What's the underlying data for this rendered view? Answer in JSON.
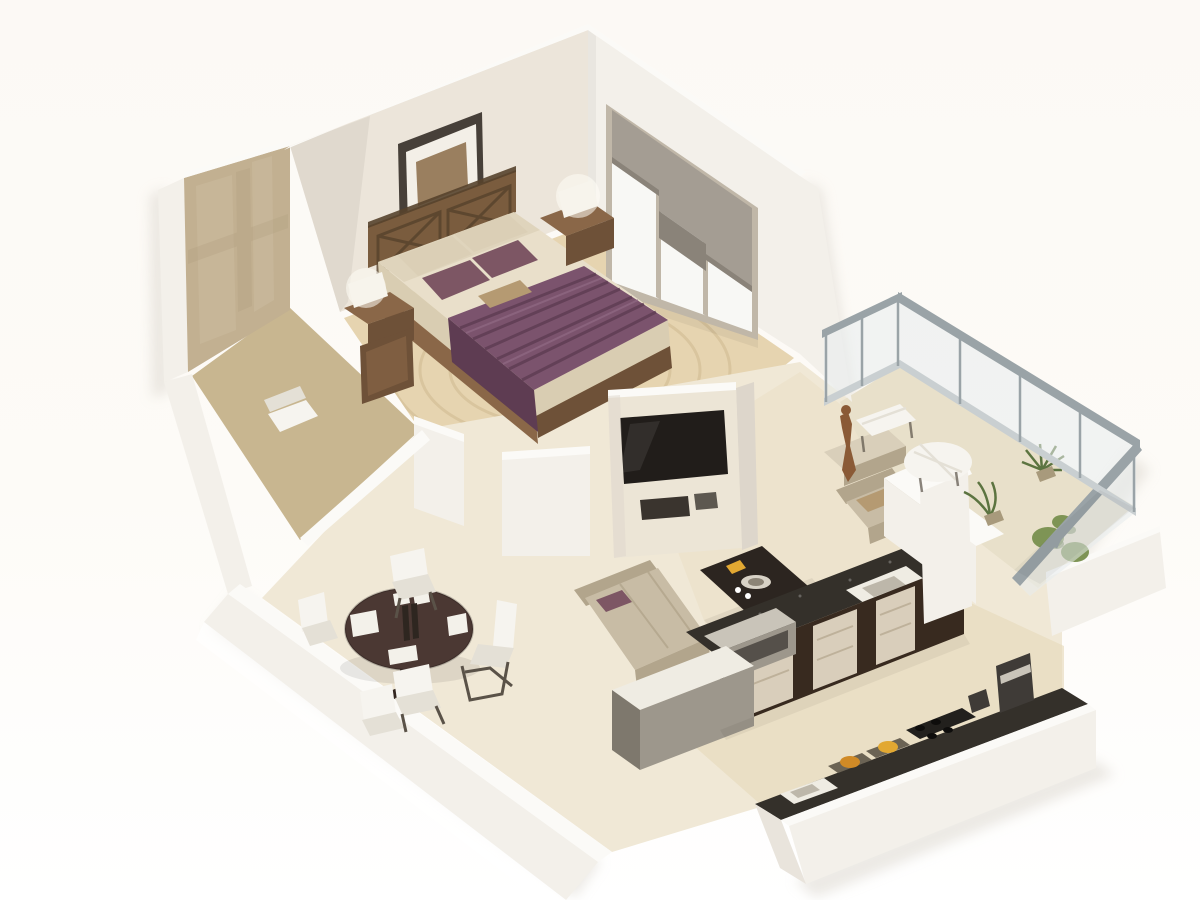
{
  "meta": {
    "alt": "3D isometric cutaway rendering of a one-bedroom apartment floor plan with bedroom, entry, dining area, living room, kitchen and balcony"
  },
  "palette": {
    "shadow": "#d9d4cb",
    "wall_bright": "#fbfaf7",
    "wall_face": "#f3f0ea",
    "wall_shade": "#e9e4dc",
    "wall_dark": "#ddd6cb",
    "wall_cream": "#ece5da",
    "marble_base": "#c2b091",
    "marble_light": "#cfc0a4",
    "marble_dark": "#ac9a7a",
    "entry_floor": "#c8b690",
    "bedroom_floor": "#e6d4b0",
    "rug_ring": "#c9b389",
    "dining_floor": "#f0e8d6",
    "living_floor": "#ebe0c6",
    "kitchen_floor": "#e6dabc",
    "balcony_floor": "#e8e0ca",
    "frame_dark": "#474039",
    "photo_mat": "#f3efe7",
    "photo_img": "#9a7f5f",
    "window_frame": "#c0b7a8",
    "glass": "#f8f8f5",
    "blind": "#a49d93",
    "blind_dark": "#8a8379",
    "headboard": "#7a5c3e",
    "headboard_dark": "#57422c",
    "wood": "#8a6748",
    "wood_dark": "#6e5138",
    "duvet": "#e9dfca",
    "duvet_shade": "#d9cdb2",
    "runner": "#7b536d",
    "runner_dark": "#5e3c52",
    "runner_light": "#916a85",
    "pillow_plum": "#7d5664",
    "pillow_cream": "#dbcfb6",
    "pillow_tan": "#b59a72",
    "lamp": "#f7f4ec",
    "lamp_glow": "#fffdf5",
    "tv_unit": "#ece5d6",
    "tv_screen": "#211d1a",
    "shelf_dark": "#3a342e",
    "sofa": "#c8bca5",
    "sofa_dark": "#b2a58c",
    "sofa_light": "#d6cbb3",
    "ctable": "#2c2520",
    "ctable_dark": "#1d1814",
    "plate": "#d8d2c6",
    "sculpture": "#8a5a36",
    "console": "#d9cfba",
    "kcab_dark": "#382a1f",
    "kdoor_marble": "#d9cebb",
    "kdoor_line": "#b8ab93",
    "granite": "#34302a",
    "sink_white": "#efece3",
    "basin": "#bdb7aa",
    "appliance": "#9d978c",
    "appliance_dark": "#7e786d",
    "appliance_light": "#c9c4b9",
    "food1": "#d08a26",
    "food2": "#e2a832",
    "board": "#6b6354",
    "burner_bg": "#22201d",
    "burner": "#0e0d0c",
    "toaster": "#3f3b37",
    "rail": "#9aa3a7",
    "rail_light": "#c9cfd1",
    "glass_blue": "#e8edee",
    "plant": "#7e9455",
    "plant_dark": "#5c7440",
    "pot": "#a89a7c",
    "chair_white": "#f6f4ef",
    "chair_shade": "#e4e0d6",
    "chair_leg": "#5a5248",
    "dtable": "#4b3833",
    "dtable_dark": "#332620",
    "placemat": "#f3f1ea",
    "bottle": "#2e2620"
  },
  "rooms": {
    "bedroom": {
      "label": "bedroom"
    },
    "entry": {
      "label": "entry-bathroom"
    },
    "dining": {
      "label": "dining-area"
    },
    "living": {
      "label": "living-room"
    },
    "kitchen": {
      "label": "kitchen"
    },
    "balcony": {
      "label": "balcony"
    }
  }
}
